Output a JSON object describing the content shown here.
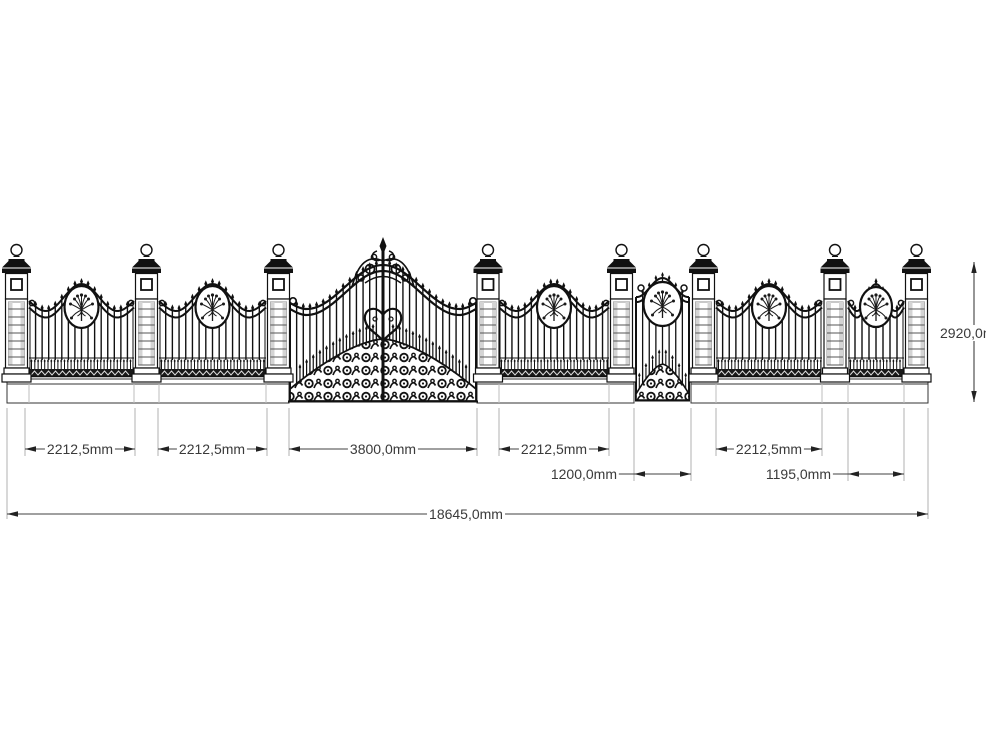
{
  "page": {
    "background": "#ffffff"
  },
  "colors": {
    "ink": "#111111",
    "dim_line": "#404040",
    "dim_text": "#3a3a3a",
    "ext_line": "#b0b0b0"
  },
  "drawing": {
    "sections": [
      {
        "name": "panel-1",
        "width_label": "2212,5mm"
      },
      {
        "name": "panel-2",
        "width_label": "2212,5mm"
      },
      {
        "name": "main-gate",
        "width_label": "3800,0mm"
      },
      {
        "name": "panel-3",
        "width_label": "2212,5mm"
      },
      {
        "name": "wicket-gate",
        "width_label": "1200,0mm"
      },
      {
        "name": "panel-4",
        "width_label": "2212,5mm"
      },
      {
        "name": "panel-5",
        "width_label": "1195,0mm"
      }
    ],
    "overall_width_label": "18645,0mm",
    "height_label": "2920,0mm"
  }
}
